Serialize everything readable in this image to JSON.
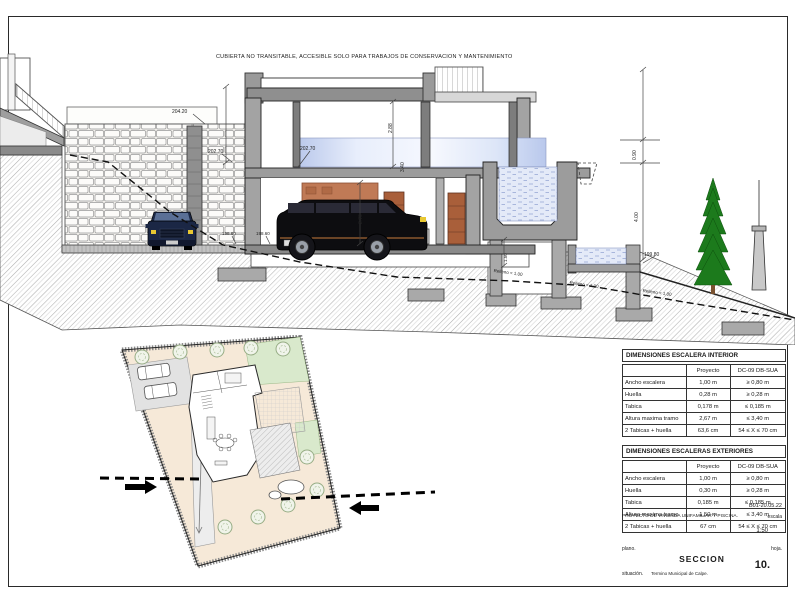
{
  "sheet": {
    "top_note": "CUBIERTA NO TRANSITABLE, ACCESIBLE SOLO PARA TRABAJOS DE CONSERVACION Y MANTENIMIENTO",
    "revision": "B01-20.05.22",
    "project_label": "PROYECTO DE VIVIENDA UNIFAMILIAR Y PISCINA.",
    "escala_label": "escala",
    "escala_value": "1:50",
    "plano_label": "plano.",
    "plano_value": "SECCION",
    "hoja_label": "hoja.",
    "hoja_value": "10.",
    "situacion_label": "situación.",
    "situacion_value": "Termino Municipal de Calpe."
  },
  "section": {
    "labels": [
      {
        "text": "204.20",
        "x": 172,
        "y": 109,
        "size": 5,
        "rot": 0
      },
      {
        "text": "202.70",
        "x": 208,
        "y": 149,
        "size": 5,
        "rot": 0
      },
      {
        "text": "202.70",
        "x": 300,
        "y": 146,
        "size": 5,
        "rot": 0
      },
      {
        "text": "198.60",
        "x": 222,
        "y": 231,
        "size": 4.5,
        "rot": 0
      },
      {
        "text": "198.60",
        "x": 256,
        "y": 231,
        "size": 4.5,
        "rot": 0
      },
      {
        "text": "199.80",
        "x": 644,
        "y": 252,
        "size": 5,
        "rot": 0
      },
      {
        "text": "0.90",
        "x": 632,
        "y": 160,
        "size": 5,
        "rot": -90
      },
      {
        "text": "4.00",
        "x": 634,
        "y": 222,
        "size": 5,
        "rot": -90
      },
      {
        "text": "2.88",
        "x": 388,
        "y": 133,
        "size": 5,
        "rot": -90
      },
      {
        "text": "3.40",
        "x": 400,
        "y": 172,
        "size": 5,
        "rot": -90
      },
      {
        "text": "2.70",
        "x": 358,
        "y": 224,
        "size": 5,
        "rot": -90
      },
      {
        "text": "1.50",
        "x": 503,
        "y": 262,
        "size": 4.5,
        "rot": -90
      },
      {
        "text": "Relleno < 1.00",
        "x": 494,
        "y": 268,
        "size": 4.5,
        "rot": 8
      },
      {
        "text": "Relleno < 1.00",
        "x": 570,
        "y": 280,
        "size": 4.5,
        "rot": 8
      },
      {
        "text": "Relleno < 1.00",
        "x": 643,
        "y": 288,
        "size": 4.5,
        "rot": 8
      }
    ]
  },
  "tables": {
    "interior": {
      "title": "DIMENSIONES ESCALERA INTERIOR",
      "columns": [
        "",
        "Proyecto",
        "DC-09 DB-SUA"
      ],
      "rows": [
        [
          "Ancho escalera",
          "1,00 m",
          "≥ 0,80 m"
        ],
        [
          "Huella",
          "0,28 m",
          "≥ 0,28 m"
        ],
        [
          "Tabica",
          "0,178 m",
          "≤ 0,185 m"
        ],
        [
          "Altura maxima tramo",
          "2,67 m",
          "≤ 3,40 m"
        ],
        [
          "2 Tabicas + huella",
          "63,6 cm",
          "54 ≤ X ≤ 70 cm"
        ]
      ]
    },
    "exterior": {
      "title": "DIMENSIONES ESCALERAS EXTERIORES",
      "columns": [
        "",
        "Proyecto",
        "DC-09 DB-SUA"
      ],
      "rows": [
        [
          "Ancho escalera",
          "1,00 m",
          "≥ 0,80 m"
        ],
        [
          "Huella",
          "0,30 m",
          "≥ 0,28 m"
        ],
        [
          "Tabica",
          "0,185 m",
          "≤ 0,185 m"
        ],
        [
          "Altura maxima tramo",
          "1,50 m",
          "≤ 3,40 m"
        ],
        [
          "2 Tabicas + huella",
          "67 cm",
          "54 ≤ X ≤ 70 cm"
        ]
      ]
    }
  },
  "colors": {
    "concrete": "#9c9c9c",
    "wall_cut": "#a3a3a3",
    "terracotta": "#c07a56",
    "door": "#a95f3a",
    "water": "#e4eaf8",
    "glass": "#b7c6ea",
    "tree_green": "#1c7a1c",
    "suv_black": "#0d0d10",
    "sedan_navy": "#1b2745",
    "site_peach": "#f6e9d8",
    "site_green": "#d9e9cc"
  }
}
